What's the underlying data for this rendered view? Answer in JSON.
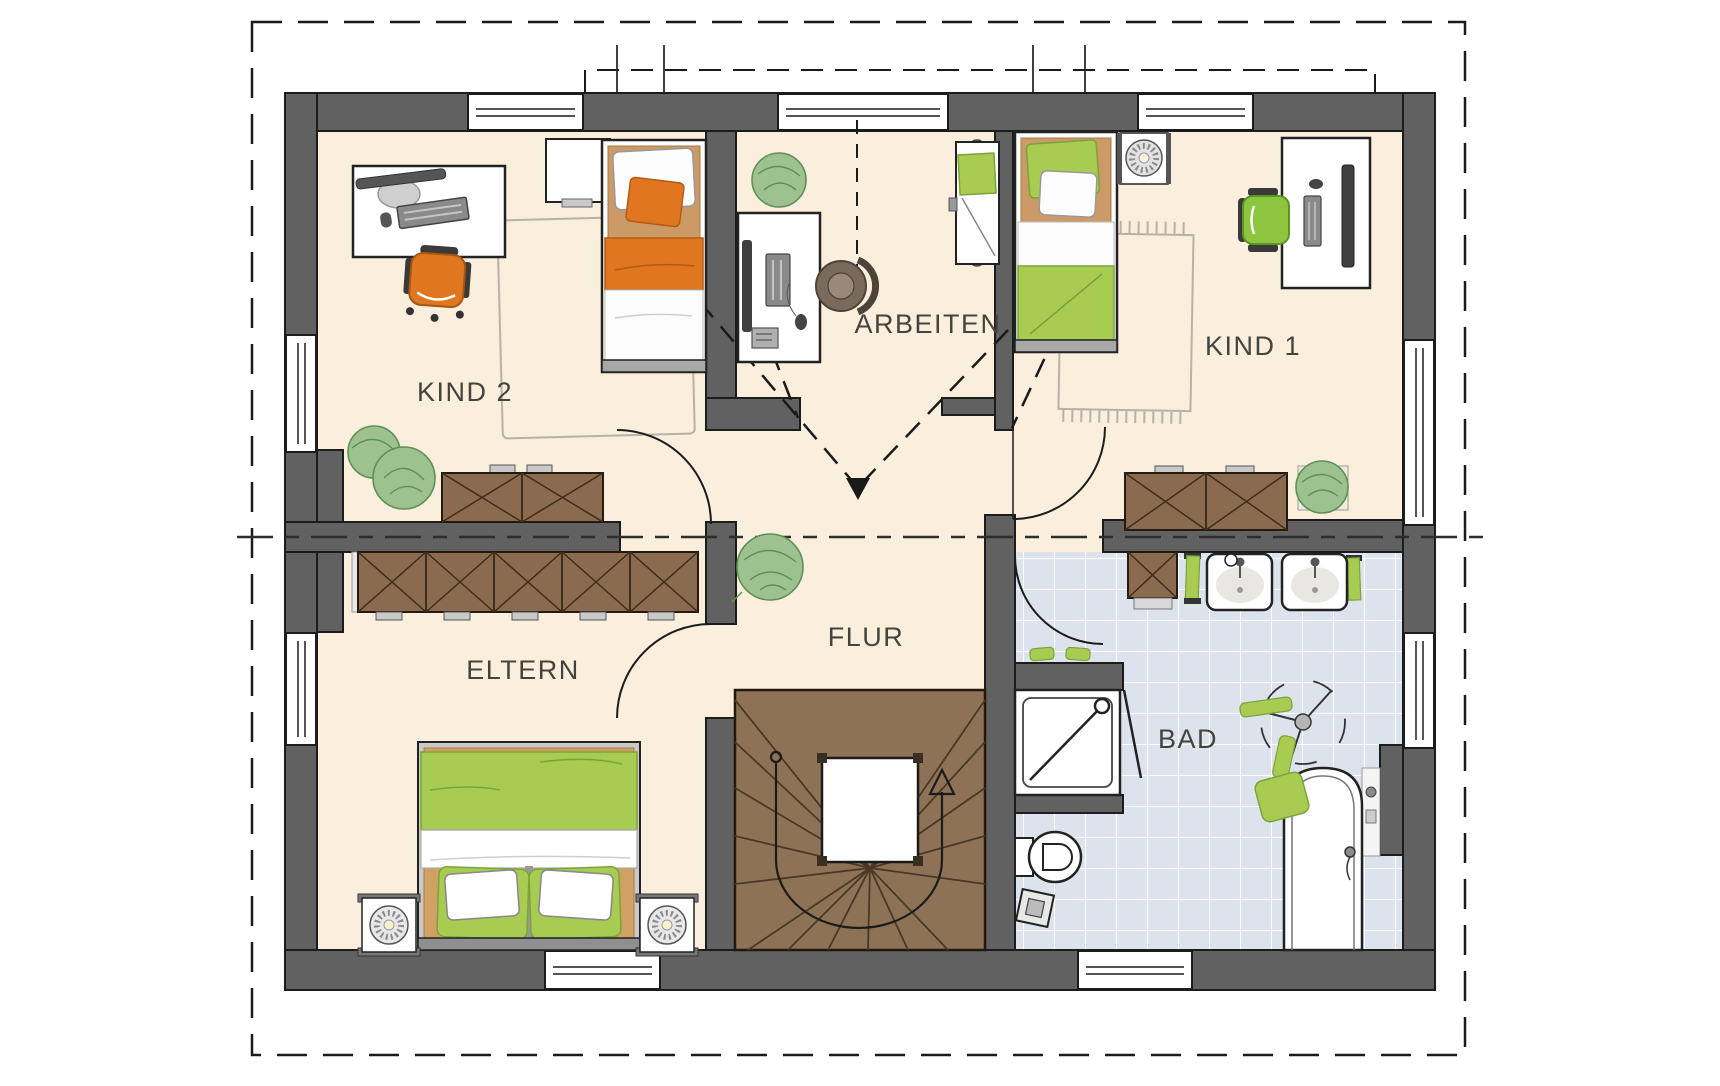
{
  "floorplan": {
    "title": "Dachgeschoss Grundriss",
    "rooms": [
      {
        "id": "kind2",
        "label": "KIND 2"
      },
      {
        "id": "arbeiten",
        "label": "ARBEITEN"
      },
      {
        "id": "kind1",
        "label": "KIND 1"
      },
      {
        "id": "eltern",
        "label": "ELTERN"
      },
      {
        "id": "flur",
        "label": "FLUR"
      },
      {
        "id": "bad",
        "label": "BAD"
      }
    ],
    "colors": {
      "wall_fill": "#616161",
      "wall_outline": "#1c1c1c",
      "floor_cream": "#faeedd",
      "bath_tile": "#dce3ed",
      "stair_wood": "#8d7256",
      "furniture_wood": "#8a6b4f",
      "textile_green": "#a8cb52",
      "textile_orange": "#e0761f",
      "plant_green": "#9ec28f"
    },
    "icons": [
      "double-bed-icon",
      "single-bed-icon",
      "folding-bed-icon",
      "desk-icon",
      "office-chair-icon",
      "wardrobe-icon",
      "sideboard-icon",
      "plant-icon",
      "rug-icon",
      "nightstand-icon",
      "bedside-lamp-icon",
      "stair-icon",
      "walkline-arrow-icon",
      "shower-icon",
      "toilet-icon",
      "bathtub-icon",
      "washbasin-icon",
      "towel-icon",
      "towel-dryer-icon",
      "window-icon",
      "door-swing-icon",
      "section-line-icon",
      "roof-outline-icon"
    ]
  }
}
